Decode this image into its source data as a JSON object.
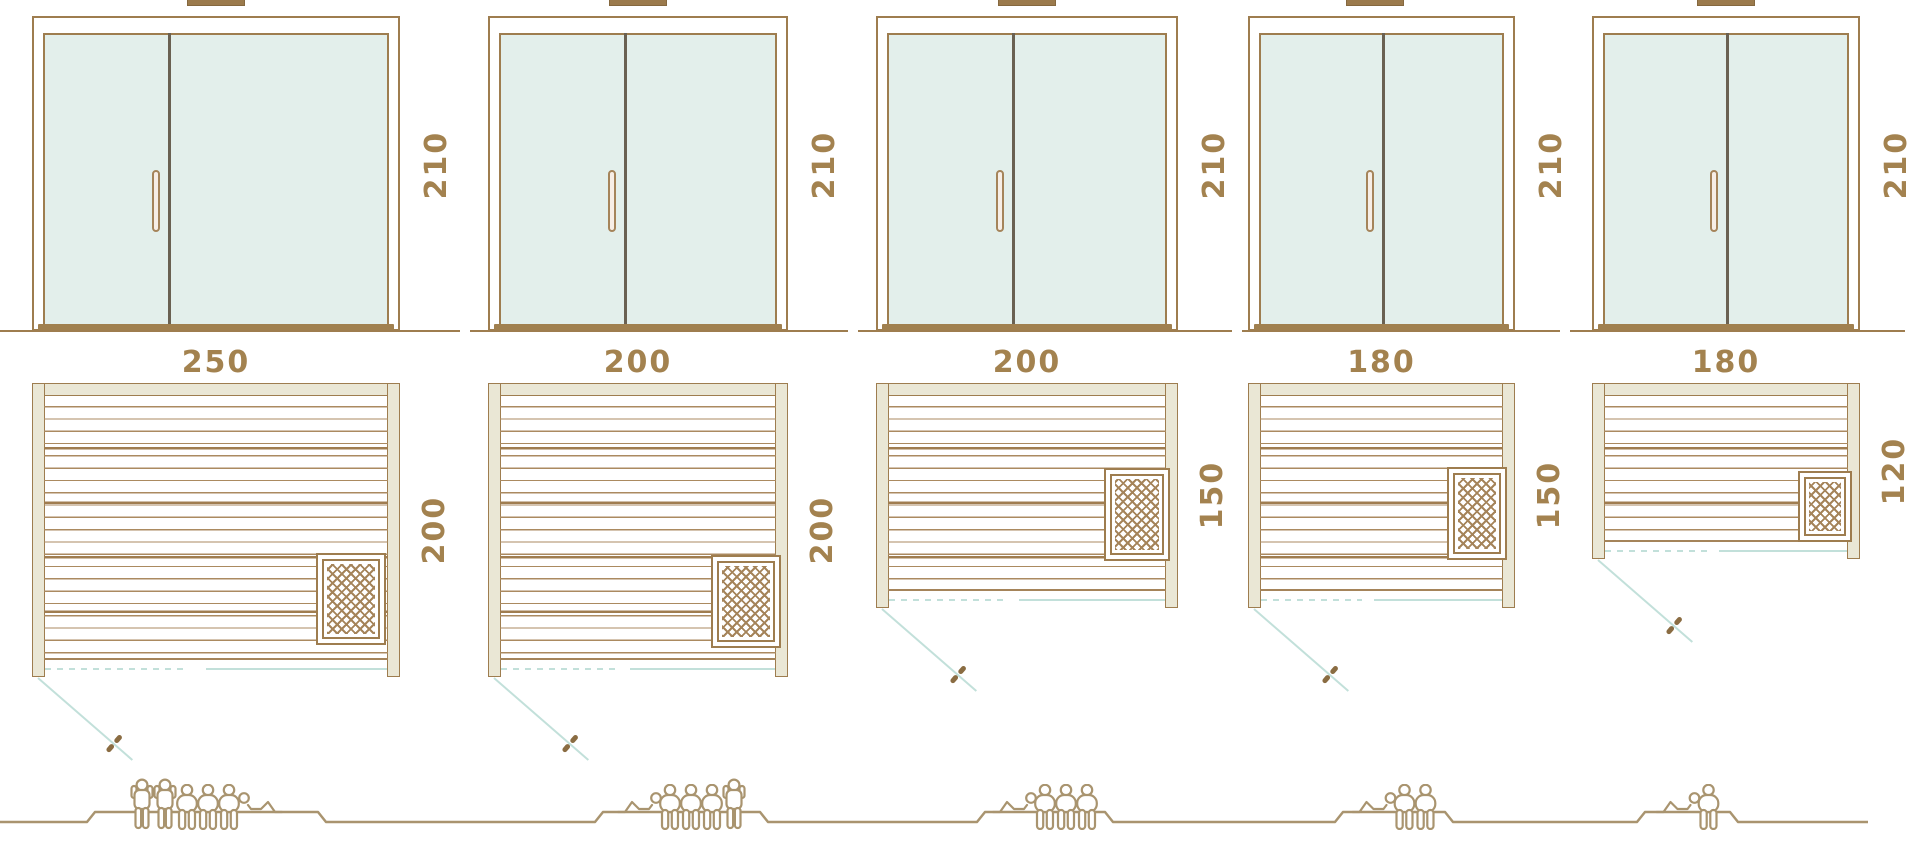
{
  "diagram_type": "sauna-size-comparison",
  "colors": {
    "frame_brown": "#9e7d4f",
    "glass_teal": "#e3efeb",
    "door_divider": "#6a6152",
    "handle_fill": "#f7eee6",
    "sill_brown": "#a0804f",
    "post_cream": "#eae7d5",
    "plank_line": "#ab8a60",
    "teal_line": "#c2e0da",
    "dimension_text": "#a3824f",
    "people_outline": "#a9946f",
    "heater_hatch": "#a5845a"
  },
  "units": [
    {
      "height_label": "210",
      "width_label": "250",
      "depth_label": "200",
      "capacity": 6,
      "figures": [
        "standing",
        "standing",
        "seated",
        "seated",
        "seated",
        "lying_head_left"
      ]
    },
    {
      "height_label": "210",
      "width_label": "200",
      "depth_label": "200",
      "capacity": 5,
      "figures": [
        "lying_head_right",
        "seated",
        "seated",
        "seated",
        "standing"
      ]
    },
    {
      "height_label": "210",
      "width_label": "200",
      "depth_label": "150",
      "capacity": 4,
      "figures": [
        "lying_head_right",
        "seated",
        "seated",
        "seated"
      ]
    },
    {
      "height_label": "210",
      "width_label": "180",
      "depth_label": "150",
      "capacity": 3,
      "figures": [
        "lying_head_right",
        "seated",
        "seated"
      ]
    },
    {
      "height_label": "210",
      "width_label": "180",
      "depth_label": "120",
      "capacity": 2,
      "figures": [
        "lying_head_right",
        "seated"
      ]
    }
  ]
}
